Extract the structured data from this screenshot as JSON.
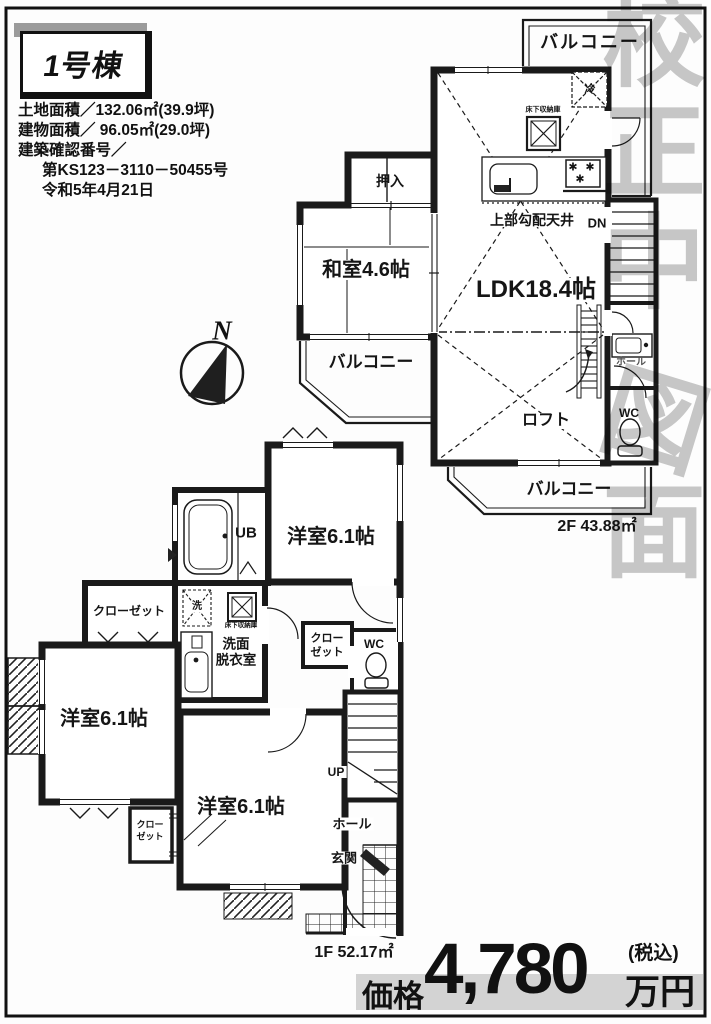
{
  "header": {
    "unit_label": "1号棟"
  },
  "property_info": {
    "lines": [
      "土地面積／132.06㎡(39.9坪)",
      "建物面積／ 96.05㎡(29.0坪)",
      "建築確認番号／",
      "第KS123－3110－50455号",
      "令和5年4月21日"
    ]
  },
  "compass": {
    "north": "N"
  },
  "watermark": {
    "chars": [
      "校",
      "正",
      "中",
      "図",
      "面"
    ]
  },
  "floor2": {
    "balcony_top": "バルコニー",
    "fridge_icon": "冷",
    "underfloor_storage": "床下収納庫",
    "burner_icon": "✱",
    "sloped_ceiling": "上部勾配天井",
    "down_label": "DN",
    "oshiire": "押入",
    "washitsu": "和室4.6帖",
    "balcony_left": "バルコニー",
    "ldk": "LDK18.4帖",
    "loft": "ロフト",
    "hall": "ホール",
    "wc": "WC",
    "balcony_bottom": "バルコニー",
    "area": "2F 43.88㎡"
  },
  "floor1": {
    "unit_bath": "UB",
    "room_top": "洋室6.1帖",
    "closet_left": "クローゼット",
    "washer_icon": "洗",
    "underfloor_storage": "床下収納庫",
    "washroom_line1": "洗面",
    "washroom_line2": "脱衣室",
    "closet_mid_line1": "クロー",
    "closet_mid_line2": "ゼット",
    "wc": "WC",
    "room_left": "洋室6.1帖",
    "room_bottom": "洋室6.1帖",
    "closet_small_line1": "クロー",
    "closet_small_line2": "ゼット",
    "up_label": "UP",
    "hall": "ホール",
    "entrance": "玄関",
    "area": "1F 52.17㎡"
  },
  "price": {
    "label": "価格",
    "amount": "4,780",
    "unit": "万円",
    "tax_note": "(税込)"
  }
}
